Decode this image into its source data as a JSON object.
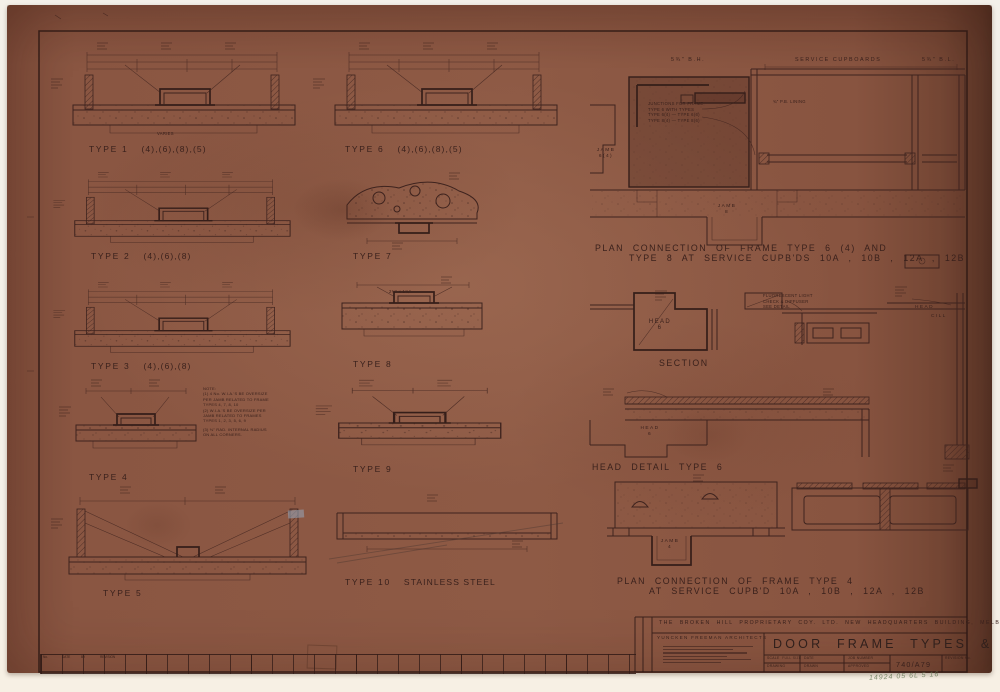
{
  "colors": {
    "paper": "#8a5641",
    "ink": "#3a211c",
    "background": "#f3f0e9",
    "handwriting": "#5f7350"
  },
  "top_labels": {
    "left": "5¾\" B.H.",
    "center": "SERVICE  CUPBOARDS",
    "right": "5¾\" B.L."
  },
  "types": {
    "t1": {
      "name": "TYPE 1",
      "suffix": "(4),(6),(8),(5)"
    },
    "t2": {
      "name": "TYPE 2",
      "suffix": "(4),(6),(8)"
    },
    "t3": {
      "name": "TYPE 3",
      "suffix": "(4),(6),(8)"
    },
    "t4": {
      "name": "TYPE 4",
      "suffix": ""
    },
    "t5": {
      "name": "TYPE 5",
      "suffix": ""
    },
    "t6": {
      "name": "TYPE 6",
      "suffix": "(4),(6),(8),(5)"
    },
    "t7": {
      "name": "TYPE 7",
      "suffix": ""
    },
    "t8": {
      "name": "TYPE 8",
      "suffix": ""
    },
    "t9": {
      "name": "TYPE 9",
      "suffix": ""
    },
    "t10": {
      "name": "TYPE 10",
      "suffix": "STAINLESS   STEEL"
    }
  },
  "captions": {
    "plan_top_1": "PLAN   CONNECTION   OF   FRAME   TYPE   6 (4)    AND",
    "plan_top_2": "TYPE  8    AT  SERVICE  CUPB'DS   10A , 10B , 12A , 12B",
    "section": "SECTION",
    "head_detail": "HEAD    DETAIL     TYPE  6",
    "plan_bottom_1": "PLAN     CONNECTION    OF   FRAME    TYPE  4",
    "plan_bottom_2": "AT   SERVICE    CUPB'D   10A , 10B , 12A , 12B"
  },
  "annotations": {
    "jamb_6_4": "JAMB",
    "jamb_6_4_sub": "6(4)",
    "jamb_8": "JAMB",
    "jamb_8_sub": "8",
    "head_6": "HEAD",
    "head_6_sub": "6",
    "head_6b": "HEAD",
    "head_6b_sub": "6",
    "jamb_4": "JAMB",
    "jamb_4_sub": "4",
    "head_small": "HEAD",
    "cill": "CILL",
    "pb_lining": "¾\" P.B.  LINING",
    "varies": "VARIES",
    "dim_2x1": "2¾\" x 1¾\"",
    "junction_note": [
      "JUNCTIONS  FOR  FRAME",
      "TYPE 6   WITH  TYPES",
      "TYPE 6(4) — TYPE 6(6)",
      "TYPE 8(4) — TYPE 8(6)"
    ],
    "fluoro_note": [
      "FLUORESCENT  LIGHT",
      "CHECK  &  DIFFUSER",
      "SEE  DETAIL"
    ],
    "note_block": [
      "NOTE:",
      "(1) 4 No. W.I.A.'S  BE  OVERSIZE",
      "PER  JAMB  RELATED  TO  FRAME",
      "TYPES  4, 7, 8, 10",
      "(2) W.I.A.'S  BE  OVERSIZE  PER",
      "JAMB  RELATED  TO  FRAMES",
      "TYPES  1, 2, 3, 5, 6, 9",
      "(3) ⅛\"  RAD.  INTERNAL  RADIUS",
      "ON  ALL  CORNERS."
    ]
  },
  "title_block": {
    "project": "THE  BROKEN  HILL  PROPRIETARY  COY.  LTD.  NEW  HEADQUARTERS  BUILDING,  MELBOURNE",
    "architects": "YUNCKEN  FREEMAN  ARCHITECTS",
    "drawing_title": "DOOR   FRAME   TYPES   &   DETAILS",
    "fields": {
      "scale_label": "SCALE",
      "scale_value": "FULL SIZE",
      "date_label": "DATE",
      "job_label": "JOB NUMBER",
      "drawing_label": "DRAWING",
      "drawn_label": "DRAWN",
      "approved_label": "APPROVED",
      "number": "740/A79",
      "revision_label": "REVISION No."
    },
    "handwriting": "14924 05 6L 5 16"
  },
  "revision_strip": {
    "h1": "No.",
    "h2": "DATE",
    "h3": "BY",
    "h4": "REVISION"
  }
}
